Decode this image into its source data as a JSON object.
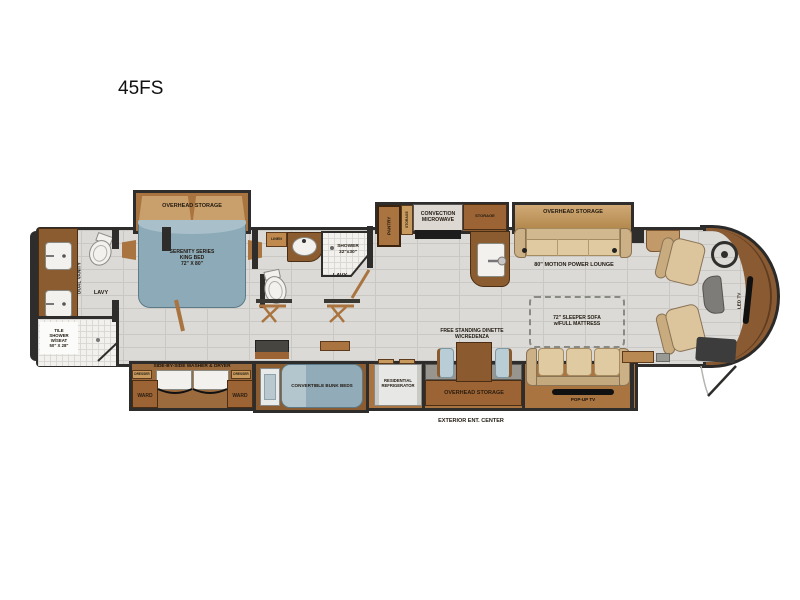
{
  "title": "45FS",
  "bedroom": {
    "overhead_storage": "OVERHEAD STORAGE",
    "king_bed": "SERENITY SERIES\nKING BED\n72\" X 80\""
  },
  "rear_bath": {
    "dual_vanity": "DUAL VANITY",
    "lavy": "LAVY",
    "tile_shower": "TILE\nSHOWER\nW/SEAT\n50\" X 28\""
  },
  "mid_bath": {
    "linen": "LINEN",
    "shower": "SHOWER\n32\"x30\"",
    "lavy": "LAVY"
  },
  "laundry": {
    "washer_dryer": "SIDE-BY-SIDE WASHER & DRYER",
    "dresser_left": "DRESSER",
    "dresser_right": "DRESSER",
    "ward_left": "WARD",
    "ward_right": "WARD"
  },
  "bunk_room": {
    "bunk": "CONVERTIBLE BUNK BEDS"
  },
  "galley": {
    "pantry": "PANTRY",
    "storage_tall": "STORAGE",
    "microwave": "CONVECTION\nMICROWAVE",
    "storage_overhead": "STORAGE"
  },
  "lounge": {
    "overhead_storage": "OVERHEAD STORAGE",
    "sofa": "80\" MOTION POWER LOUNGE"
  },
  "living": {
    "refrigerator": "RESIDENTIAL\nREFRIGERATOR",
    "overhead_storage": "OVERHEAD STORAGE",
    "dinette": "FREE STANDING DINETTE\nW/CREDENZA",
    "sleeper_sofa": "72\" SLEEPER SOFA\nw/FULL MATTRESS",
    "popup_tv": "POP-UP TV",
    "exterior_ent_center": "EXTERIOR ENT. CENTER"
  },
  "cockpit": {
    "led_tv": "LED TV"
  },
  "colors": {
    "wall": "#2e2d2b",
    "floor": "#dbdad6",
    "wood": "#9c6434",
    "wood_light": "#c99a5e",
    "overhead_tan": "#c9a06b",
    "bed_blue": "#8caab8",
    "sofa_tan": "#dcc49c",
    "chair_blue": "#b9cdd6",
    "cap_brown": "#8a5b33"
  }
}
